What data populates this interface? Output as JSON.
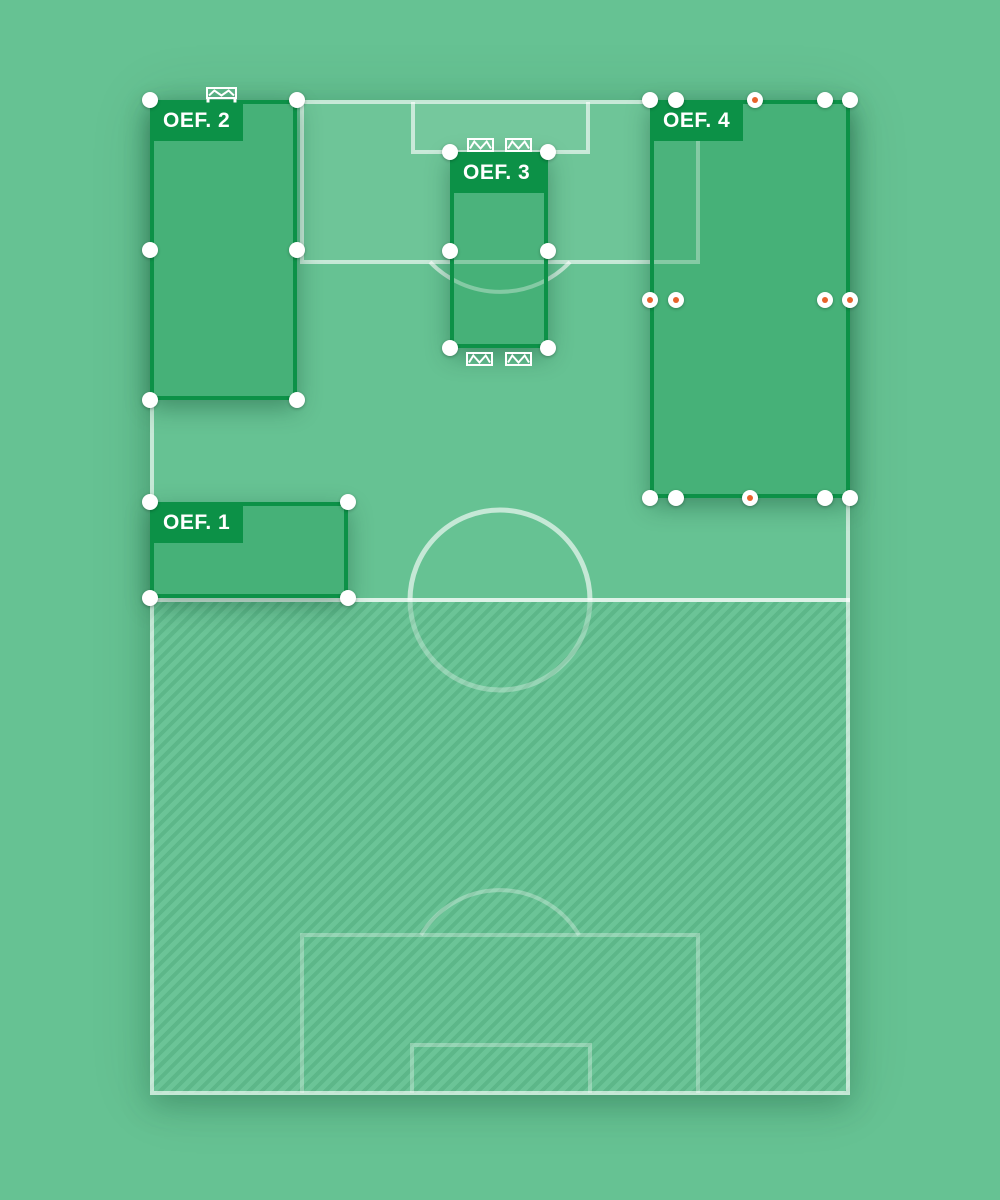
{
  "app": {
    "title": "Training exercise planner pitch"
  },
  "colors": {
    "background": "#66c293",
    "line": "rgba(255,255,255,0.62)",
    "line_bright": "rgba(255,255,255,0.78)",
    "line_faint": "rgba(255,255,255,0.30)",
    "area_fill": "rgba(255,255,255,0.055)",
    "zone_border": "#0c9147",
    "zone_fill": "rgba(12,145,71,0.35)",
    "label_bg": "#0c9147",
    "label_text": "#ffffff",
    "handle_fill": "#ffffff",
    "handle_accent": "#e8632c",
    "goal_icon": "#ffffff"
  },
  "pitch": {
    "x": 150,
    "y": 100,
    "width": 700,
    "height": 995,
    "halfway_y": 600,
    "center_circle": {
      "cx": 500,
      "cy": 600,
      "r": 90
    },
    "penalty_area_top": {
      "x": 302,
      "y": 102,
      "w": 396,
      "h": 160
    },
    "goal_area_top": {
      "x": 413,
      "y": 102,
      "w": 175,
      "h": 50
    },
    "penalty_arc_top": {
      "x1": 430,
      "x2": 570,
      "y": 262,
      "r": 97
    },
    "penalty_area_bottom": {
      "x": 302,
      "y": 935,
      "w": 396,
      "h": 158
    },
    "goal_area_bottom": {
      "x": 412,
      "y": 1045,
      "w": 178,
      "h": 48
    },
    "penalty_arc_bottom": {
      "x1": 421,
      "x2": 579,
      "y": 935,
      "r": 92
    },
    "unused_half": {
      "x": 150,
      "y": 602,
      "width": 700,
      "height": 491
    }
  },
  "zones": [
    {
      "id": "oef-2",
      "label": "OEF. 2",
      "x": 150,
      "y": 100,
      "width": 147,
      "height": 300,
      "handles": [
        {
          "x": 0,
          "y": 0
        },
        {
          "x": 147,
          "y": 0
        },
        {
          "x": 0,
          "y": 150
        },
        {
          "x": 147,
          "y": 150
        },
        {
          "x": 0,
          "y": 300
        },
        {
          "x": 147,
          "y": 300
        }
      ]
    },
    {
      "id": "oef-3",
      "label": "OEF. 3",
      "x": 450,
      "y": 152,
      "width": 98,
      "height": 196,
      "label_full_width": true,
      "handles": [
        {
          "x": 0,
          "y": 0
        },
        {
          "x": 98,
          "y": 0
        },
        {
          "x": 0,
          "y": 99
        },
        {
          "x": 98,
          "y": 99
        },
        {
          "x": 0,
          "y": 196
        },
        {
          "x": 98,
          "y": 196
        }
      ]
    },
    {
      "id": "oef-4",
      "label": "OEF. 4",
      "x": 650,
      "y": 100,
      "width": 200,
      "height": 398,
      "inner_rect": {
        "x": 26,
        "y": 0,
        "width": 149,
        "height": 398
      },
      "handles": [
        {
          "x": 0,
          "y": 0
        },
        {
          "x": 26,
          "y": 0
        },
        {
          "x": 175,
          "y": 0
        },
        {
          "x": 200,
          "y": 0
        },
        {
          "x": 0,
          "y": 398
        },
        {
          "x": 26,
          "y": 398
        },
        {
          "x": 175,
          "y": 398
        },
        {
          "x": 200,
          "y": 398
        },
        {
          "x": 105,
          "y": 0,
          "accent": true
        },
        {
          "x": 100,
          "y": 398,
          "accent": true
        },
        {
          "x": 0,
          "y": 200,
          "accent": true
        },
        {
          "x": 26,
          "y": 200,
          "accent": true
        },
        {
          "x": 175,
          "y": 200,
          "accent": true
        },
        {
          "x": 200,
          "y": 200,
          "accent": true
        }
      ]
    },
    {
      "id": "oef-1",
      "label": "OEF. 1",
      "x": 150,
      "y": 502,
      "width": 198,
      "height": 96,
      "handles": [
        {
          "x": 0,
          "y": 0
        },
        {
          "x": 198,
          "y": 0
        },
        {
          "x": 0,
          "y": 96
        },
        {
          "x": 198,
          "y": 96
        }
      ]
    }
  ],
  "goals": [
    {
      "name": "mini-goal-oef2",
      "x": 206,
      "y": 87,
      "w": 31,
      "h": 16,
      "posts": true
    },
    {
      "name": "mini-goal-oef3-top-left",
      "x": 467,
      "y": 138,
      "w": 27,
      "h": 14
    },
    {
      "name": "mini-goal-oef3-top-right",
      "x": 505,
      "y": 138,
      "w": 27,
      "h": 14
    },
    {
      "name": "mini-goal-oef3-bottom-left",
      "x": 466,
      "y": 352,
      "w": 27,
      "h": 14
    },
    {
      "name": "mini-goal-oef3-bottom-right",
      "x": 505,
      "y": 352,
      "w": 27,
      "h": 14
    }
  ]
}
